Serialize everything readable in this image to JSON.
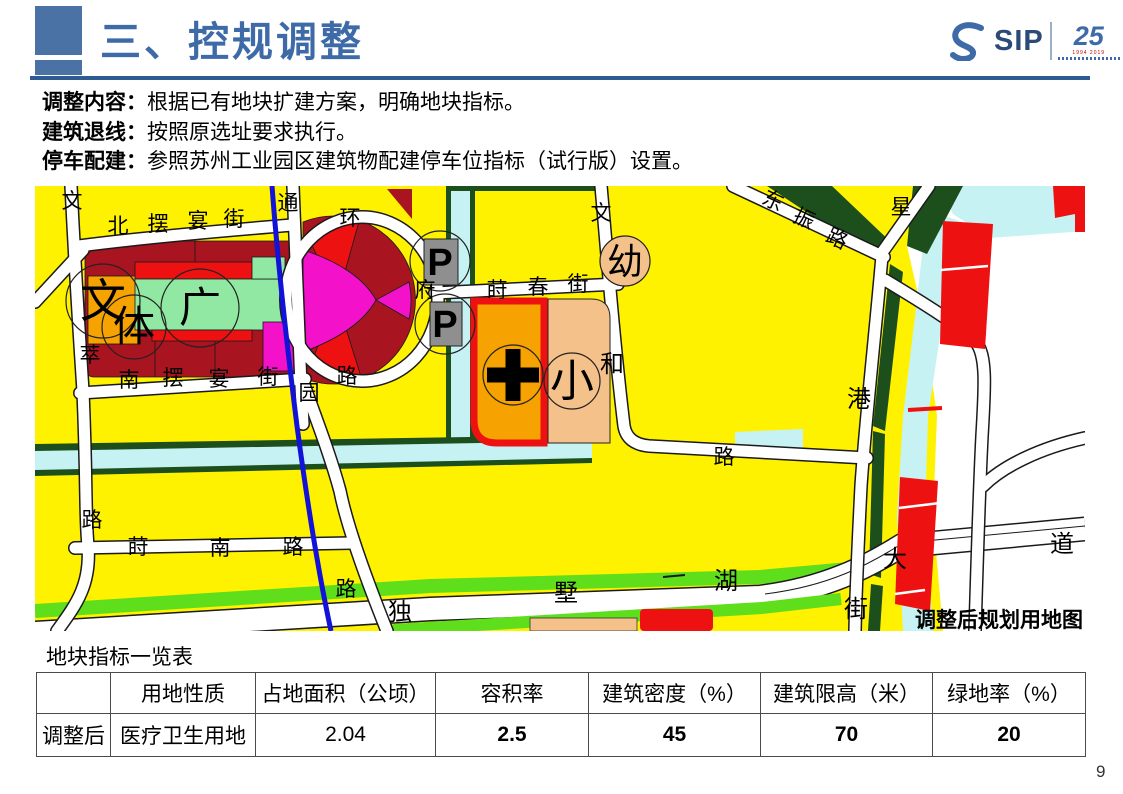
{
  "header": {
    "title": "三、控规调整",
    "logo": {
      "sip": "SIP",
      "anniversary": "25",
      "years": "1994 2019"
    }
  },
  "notes": [
    {
      "label": "调整内容",
      "colon": "：",
      "text": "根据已有地块扩建方案，明确地块指标。"
    },
    {
      "label": "建筑退线",
      "colon": "：",
      "text": "按照原选址要求执行。"
    },
    {
      "label": "停车配建",
      "colon": "：",
      "text": "参照苏州工业园区建筑物配建停车位指标（试行版）设置。"
    }
  ],
  "map": {
    "caption": "调整后规划用地图",
    "labels": [
      {
        "text": "文"
      },
      {
        "text": "北"
      },
      {
        "text": "摆"
      },
      {
        "text": "宴"
      },
      {
        "text": "街"
      },
      {
        "text": "通"
      },
      {
        "text": "环"
      },
      {
        "text": "府"
      },
      {
        "text": "莳"
      },
      {
        "text": "春"
      },
      {
        "text": "街"
      },
      {
        "text": "文"
      },
      {
        "text": "东"
      },
      {
        "text": "振"
      },
      {
        "text": "路"
      },
      {
        "text": "星"
      },
      {
        "text": "萃"
      },
      {
        "text": "南"
      },
      {
        "text": "摆"
      },
      {
        "text": "宴"
      },
      {
        "text": "街"
      },
      {
        "text": "园"
      },
      {
        "text": "路"
      },
      {
        "text": "和"
      },
      {
        "text": "港"
      },
      {
        "text": "路"
      },
      {
        "text": "路"
      },
      {
        "text": "莳"
      },
      {
        "text": "南"
      },
      {
        "text": "路"
      },
      {
        "text": "路"
      },
      {
        "text": "独"
      },
      {
        "text": "墅"
      },
      {
        "text": "湖"
      },
      {
        "text": "大"
      },
      {
        "text": "道"
      },
      {
        "text": "街"
      },
      {
        "text": "文"
      },
      {
        "text": "体"
      },
      {
        "text": "广"
      },
      {
        "text": "幼"
      },
      {
        "text": "小"
      },
      {
        "text": "P"
      },
      {
        "text": "P"
      }
    ]
  },
  "table": {
    "title": "地块指标一览表",
    "headers": [
      "",
      "用地性质",
      "占地面积（公顷）",
      "容积率",
      "建筑密度（%）",
      "建筑限高（米）",
      "绿地率（%）"
    ],
    "row_label": "调整后",
    "row": [
      "医疗卫生用地",
      "2.04",
      "2.5",
      "45",
      "70",
      "20"
    ]
  },
  "page_number": "9",
  "colors": {
    "header_blue": "#3E6BA8",
    "rule_blue": "#2F5B93",
    "value_red": "#C00000",
    "land_yellow": "#FFF200",
    "land_darkred": "#A81420",
    "land_red": "#EE1111",
    "land_magenta": "#F311C9",
    "land_orange": "#F6A200",
    "land_peach": "#F5C18B",
    "land_mint": "#90E8A2",
    "green_bright": "#5FDE1C",
    "green_dark": "#1D4F1D",
    "water_cyan": "#C7F2F3",
    "river_blue": "#1212D8",
    "parking_gray": "#8F8F8F"
  }
}
